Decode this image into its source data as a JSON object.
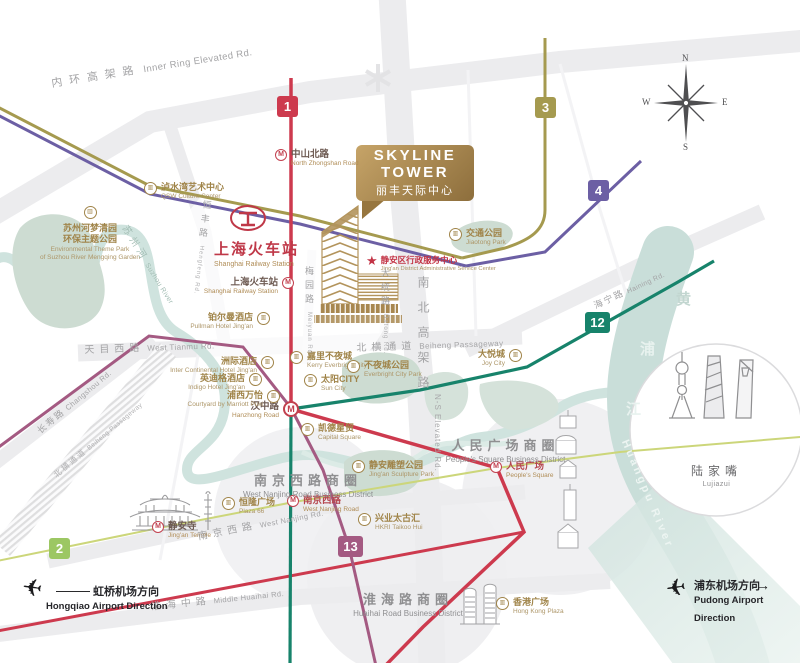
{
  "title_callout": {
    "line1": "SKYLINE",
    "line2": "TOWER",
    "subtitle": "丽丰天际中心"
  },
  "compass": {
    "n": "N",
    "e": "E",
    "s": "S",
    "w": "W"
  },
  "icons": {
    "metro_logo": "M",
    "poi_building": "▥",
    "star": "★",
    "plane": "✈",
    "arrow_right": "→"
  },
  "lines": {
    "l1": {
      "num": "1"
    },
    "l2": {
      "num": "2"
    },
    "l3": {
      "num": "3"
    },
    "l4": {
      "num": "4"
    },
    "l12": {
      "num": "12"
    },
    "l13": {
      "num": "13"
    }
  },
  "colors": {
    "line1": "#cd3a4e",
    "line2": "#9cc763",
    "line2_track": "#ccd67a",
    "line3": "#a59a4f",
    "line4": "#6c5fa4",
    "line12": "#17836b",
    "line13": "#a45a82",
    "gold": "#a08449",
    "rail_red": "#bf3848",
    "river": "#c9ded9",
    "park": "#cddcd2"
  },
  "stations": {
    "north_zhongshan": {
      "zh": "中山北路",
      "en": "North Zhongshan Road"
    },
    "shanghai_railway": {
      "zh": "上海火车站",
      "en": "Shanghai Railway Station"
    },
    "hanzhong": {
      "zh": "汉中路",
      "en": "Hanzhong Road"
    },
    "peoples_square": {
      "zh": "人民广场",
      "en": "People's Square"
    },
    "west_nanjing": {
      "zh": "南京西路",
      "en": "West Nanjing Road"
    },
    "jingan_temple": {
      "zh": "静安寺",
      "en": "Jing'an Temple"
    }
  },
  "landmarks": {
    "railway_station": {
      "zh": "上海火车站",
      "en": "Shanghai Railway Station"
    },
    "lujiazui": {
      "zh": "陆家嘴",
      "en": "Lujiazui"
    },
    "admin_center": {
      "zh": "静安区行政服务中心",
      "en": "Jing'an District Administrative Service Center"
    }
  },
  "pois": {
    "qsw": {
      "zh": "泸水湾艺术中心",
      "en": "QSW Culture Center"
    },
    "mengqing": {
      "zh1": "苏州河梦清园",
      "zh2": "环保主题公园",
      "en1": "Environmental Theme Park",
      "en2": "of Suzhou River Mengqing Garden"
    },
    "pullman": {
      "zh": "铂尔曼酒店",
      "en": "Pullman Hotel Jing'an"
    },
    "intercontinental": {
      "zh": "洲际酒店",
      "en": "Inter Continental Hotel Jing'an"
    },
    "indigo": {
      "zh": "英迪格酒店",
      "en": "Indigo Hotel Jing'an"
    },
    "courtyard": {
      "zh": "浦西万怡",
      "en": "Courtyard by Marriott Puxi"
    },
    "kerry": {
      "zh": "嘉里不夜城",
      "en": "Kerry Everbright City"
    },
    "suncity": {
      "zh": "太阳CITY",
      "en": "Sun City"
    },
    "everbright_park": {
      "zh": "不夜城公园",
      "en": "Everbright City Park"
    },
    "joycity": {
      "zh": "大悦城",
      "en": "Joy City"
    },
    "jiaotong_park": {
      "zh": "交通公园",
      "en": "Jiaotong Park"
    },
    "capital_square": {
      "zh": "凯德星贸",
      "en": "Capital Square"
    },
    "sculpture_park": {
      "zh": "静安雕塑公园",
      "en": "Jing'an Sculpture Park"
    },
    "taikoo_hui": {
      "zh": "兴业太古汇",
      "en": "HKRI Taikoo Hui"
    },
    "plaza66": {
      "zh": "恒隆广场",
      "en": "Plaza 66"
    },
    "hk_plaza": {
      "zh": "香港广场",
      "en": "Hong Kong Plaza"
    }
  },
  "districts": {
    "peoples": {
      "zh": "人民广场商圈",
      "en": "People's Square Business District"
    },
    "west_nanjing": {
      "zh": "南京西路商圈",
      "en": "West Nanjing Road Business District"
    },
    "huaihai": {
      "zh": "淮海路商圈",
      "en": "Huaihai Road Business District"
    }
  },
  "roads": {
    "inner_ring": {
      "zh": "内环高架路",
      "en": "Inner Ring Elevated Rd."
    },
    "west_tianmu": {
      "zh": "天目西路",
      "en": "West Tianmu Rd."
    },
    "beiheng": {
      "zh": "北横通道",
      "en": "Beiheng Passageway"
    },
    "beiheng_w": {
      "zh": "北横通道",
      "en": "Beiheng Passageway"
    },
    "ns_elevated": {
      "zh": "南北高架路",
      "en": "N-S Elevated Rd."
    },
    "datong": {
      "zh": "大统路",
      "en": "Datong Rd."
    },
    "meiyuan": {
      "zh": "梅园路",
      "en": "Meiyuan Rd."
    },
    "hengfeng": {
      "zh": "恒丰路",
      "en": "Hengfeng Rd."
    },
    "changshou": {
      "zh": "长寿路",
      "en": "Changshou Rd."
    },
    "west_nanjing_rd": {
      "zh": "南京西路",
      "en": "West Nanjing Rd."
    },
    "mid_huaihai": {
      "zh": "淮海中路",
      "en": "Middle Huaihai Rd."
    },
    "haining": {
      "zh": "海宁路",
      "en": "Haining Rd."
    }
  },
  "rivers": {
    "suzhou": {
      "zh": "苏州河",
      "en": "Suzhou River"
    },
    "huangpu": {
      "c1": "黄",
      "c2": "浦",
      "c3": "江",
      "en": "Huangpu River"
    }
  },
  "airports": {
    "hongqiao": {
      "zh": "虹桥机场方向",
      "en": "Hongqiao Airport Direction"
    },
    "pudong": {
      "zh": "浦东机场方向",
      "en": "Pudong Airport Direction"
    }
  }
}
